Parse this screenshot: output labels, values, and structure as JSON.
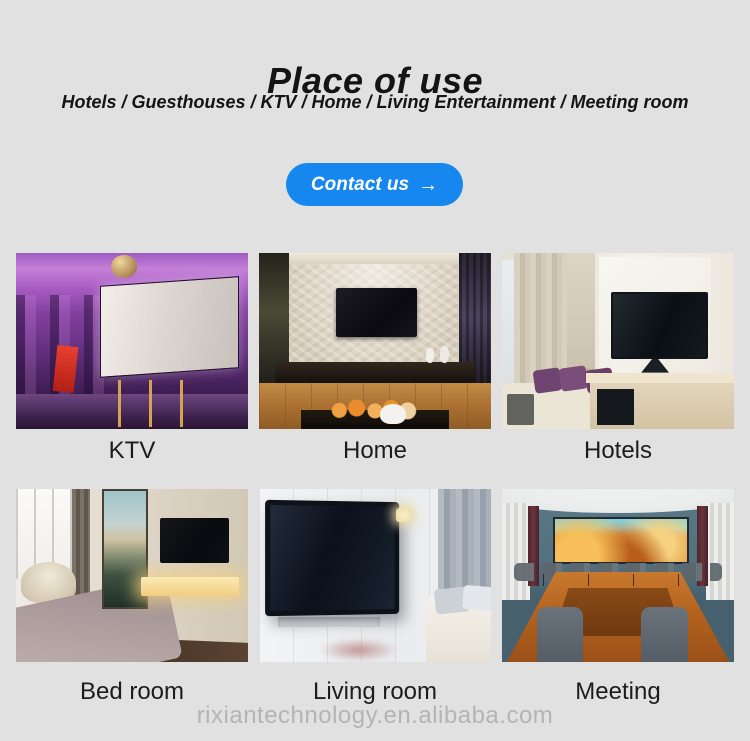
{
  "header": {
    "title": "Place of use",
    "subtitle": "Hotels / Guesthouses / KTV / Home / Living Entertainment / Meeting room"
  },
  "contact": {
    "label": "Contact us",
    "arrow": "→"
  },
  "gallery": {
    "items": [
      {
        "caption": "KTV"
      },
      {
        "caption": "Home"
      },
      {
        "caption": "Hotels"
      },
      {
        "caption": "Bed room"
      },
      {
        "caption": "Living room"
      },
      {
        "caption": "Meeting"
      }
    ]
  },
  "footer": {
    "watermark": "rixiantechnology.en.alibaba.com"
  },
  "colors": {
    "background": "#e1e1e1",
    "button_blue": "#1787f0",
    "button_text": "#ffffff",
    "heading_text": "#141414",
    "caption_text": "#1c1c1c",
    "watermark_text": "#b4b4b4"
  }
}
